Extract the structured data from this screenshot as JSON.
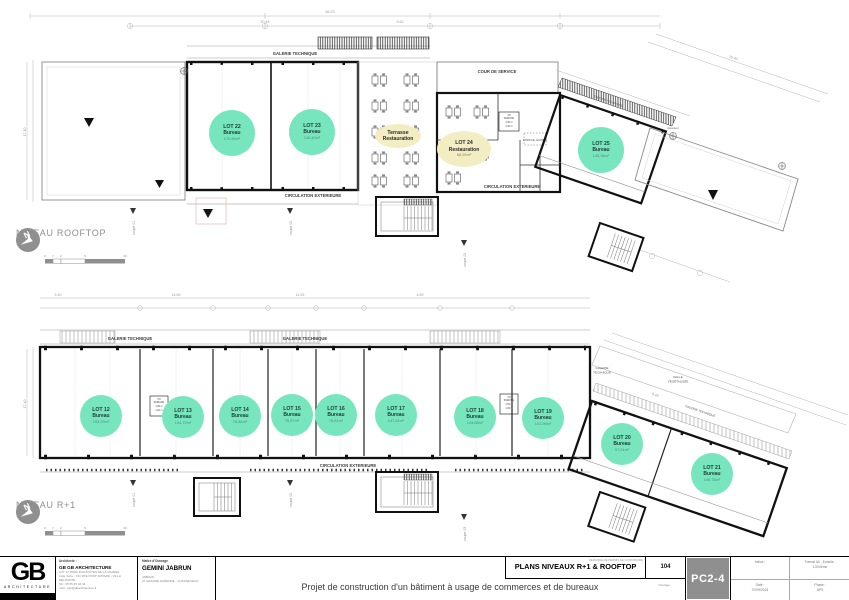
{
  "sheet": {
    "rooftop_label": "NIVEAU ROOFTOP",
    "r1_label": "NIVEAU R+1"
  },
  "colors": {
    "lot_green": "#77E6BF",
    "highlight_yellow": "#F3EDC4",
    "code_gray": "#8F8F8F"
  },
  "rooftop": {
    "labels": {
      "galerie": "GALERIE TECHNIQUE",
      "cour": "COUR DE SERVICE",
      "circulation": "CIRCULATION EXTERIEURE",
      "espace_gaines": "ESPACE GAINES",
      "ascenseur": "Ascenseur"
    },
    "terrasse": {
      "l1": "Terrasse",
      "l2": "Restauration"
    },
    "vh": {
      "l1": "VH",
      "l2": "PARKING",
      "l3": "1,50 m",
      "l4": "1,00 m"
    },
    "lots": [
      {
        "id": "LOT 22",
        "type": "Bureau",
        "area": "170,90m²"
      },
      {
        "id": "LOT 23",
        "type": "Bureau",
        "area": "146,40m²"
      },
      {
        "id": "LOT 24",
        "type": "Restauration",
        "area": "68,25m²"
      },
      {
        "id": "LOT 25",
        "type": "Bureau",
        "area": "145,38m²"
      }
    ]
  },
  "r1": {
    "labels": {
      "galerie": "GALERIE TECHNIQUE",
      "circulation": "CIRCULATION EXTERIEURE",
      "galerie2_l1": "GALERIE",
      "galerie2_l2": "TECHNIQUE",
      "dalle_l1": "DALLE",
      "dalle_l2": "VÉGÉTALISÉE"
    },
    "vh": {
      "l1": "VH",
      "l2": "PARKING",
      "l3": "1,50 m",
      "l4": "1,00 m"
    },
    "lots": [
      {
        "id": "LOT 12",
        "type": "Bureau",
        "area": "153,29m²"
      },
      {
        "id": "LOT 13",
        "type": "Bureau",
        "area": "144,72m²"
      },
      {
        "id": "LOT 14",
        "type": "Bureau",
        "area": "76,84m²"
      },
      {
        "id": "LOT 15",
        "type": "Bureau",
        "area": "76,57m²"
      },
      {
        "id": "LOT 16",
        "type": "Bureau",
        "area": "76,81m²"
      },
      {
        "id": "LOT 17",
        "type": "Bureau",
        "area": "147,41m²"
      },
      {
        "id": "LOT 18",
        "type": "Bureau",
        "area": "144,88m²"
      },
      {
        "id": "LOT 19",
        "type": "Bureau",
        "area": "151,96m²"
      },
      {
        "id": "LOT 20",
        "type": "Bureau",
        "area": "97,01m²"
      },
      {
        "id": "LOT 21",
        "type": "Bureau",
        "area": "149,75m²"
      }
    ]
  },
  "coupes": {
    "c1": "coupe 01",
    "c2": "coupe 02",
    "c3": "coupe 03"
  },
  "scalebar": {
    "t0": "0",
    "t1": "1",
    "t2": "2",
    "t5": "5",
    "t10": "10"
  },
  "dims": {
    "a1": "66.23",
    "a2": "20.44",
    "a3": "9.62",
    "a4": "17.10",
    "a5": "15.40",
    "b1": "5.40",
    "b2": "14.89",
    "b3": "11.93",
    "b4": "4.89",
    "b5": "17.40",
    "b6": "9.43"
  },
  "titleblock": {
    "logo": {
      "text": "GB",
      "sub": "ARCHITECTURE"
    },
    "architect": {
      "label": "Architecte :",
      "name": "GB GB ARCHITECTURE",
      "lines": [
        "LOT 27 PARC D'ACTIVITES DE LA JALIERE",
        "Côte Verte - 471 RTE PONT ROTARD - VILLA DELOURTE",
        "Tel : 05 55 45 44 44",
        "mail : sgb@gbarchitecture.fr"
      ]
    },
    "client": {
      "label": "Maître d'Ouvrage",
      "name": "GEMINI JABRUN",
      "lines": [
        "JABRUN",
        "27 GRANDE GARENNE - CHASSENEUIL"
      ]
    },
    "doc": {
      "header": "DEMANDE DE PERMIS DE CONSTRUIRE",
      "title": "PLANS NIVEAUX R+1 & ROOFTOP"
    },
    "project": "Projet de construction d'un bâtiment à usage de commerces et de bureaux",
    "number": "104",
    "ouvrage_label": "Ouvrage :",
    "code": "PC2-4",
    "meta": {
      "indice_label": "Indice :",
      "format_l1": "Format A0 - Echelle :",
      "format_l2": "1/200ème",
      "date_label": "Date :",
      "date": "07/09/2023",
      "phase_label": "Phase :",
      "phase": "APS"
    }
  }
}
